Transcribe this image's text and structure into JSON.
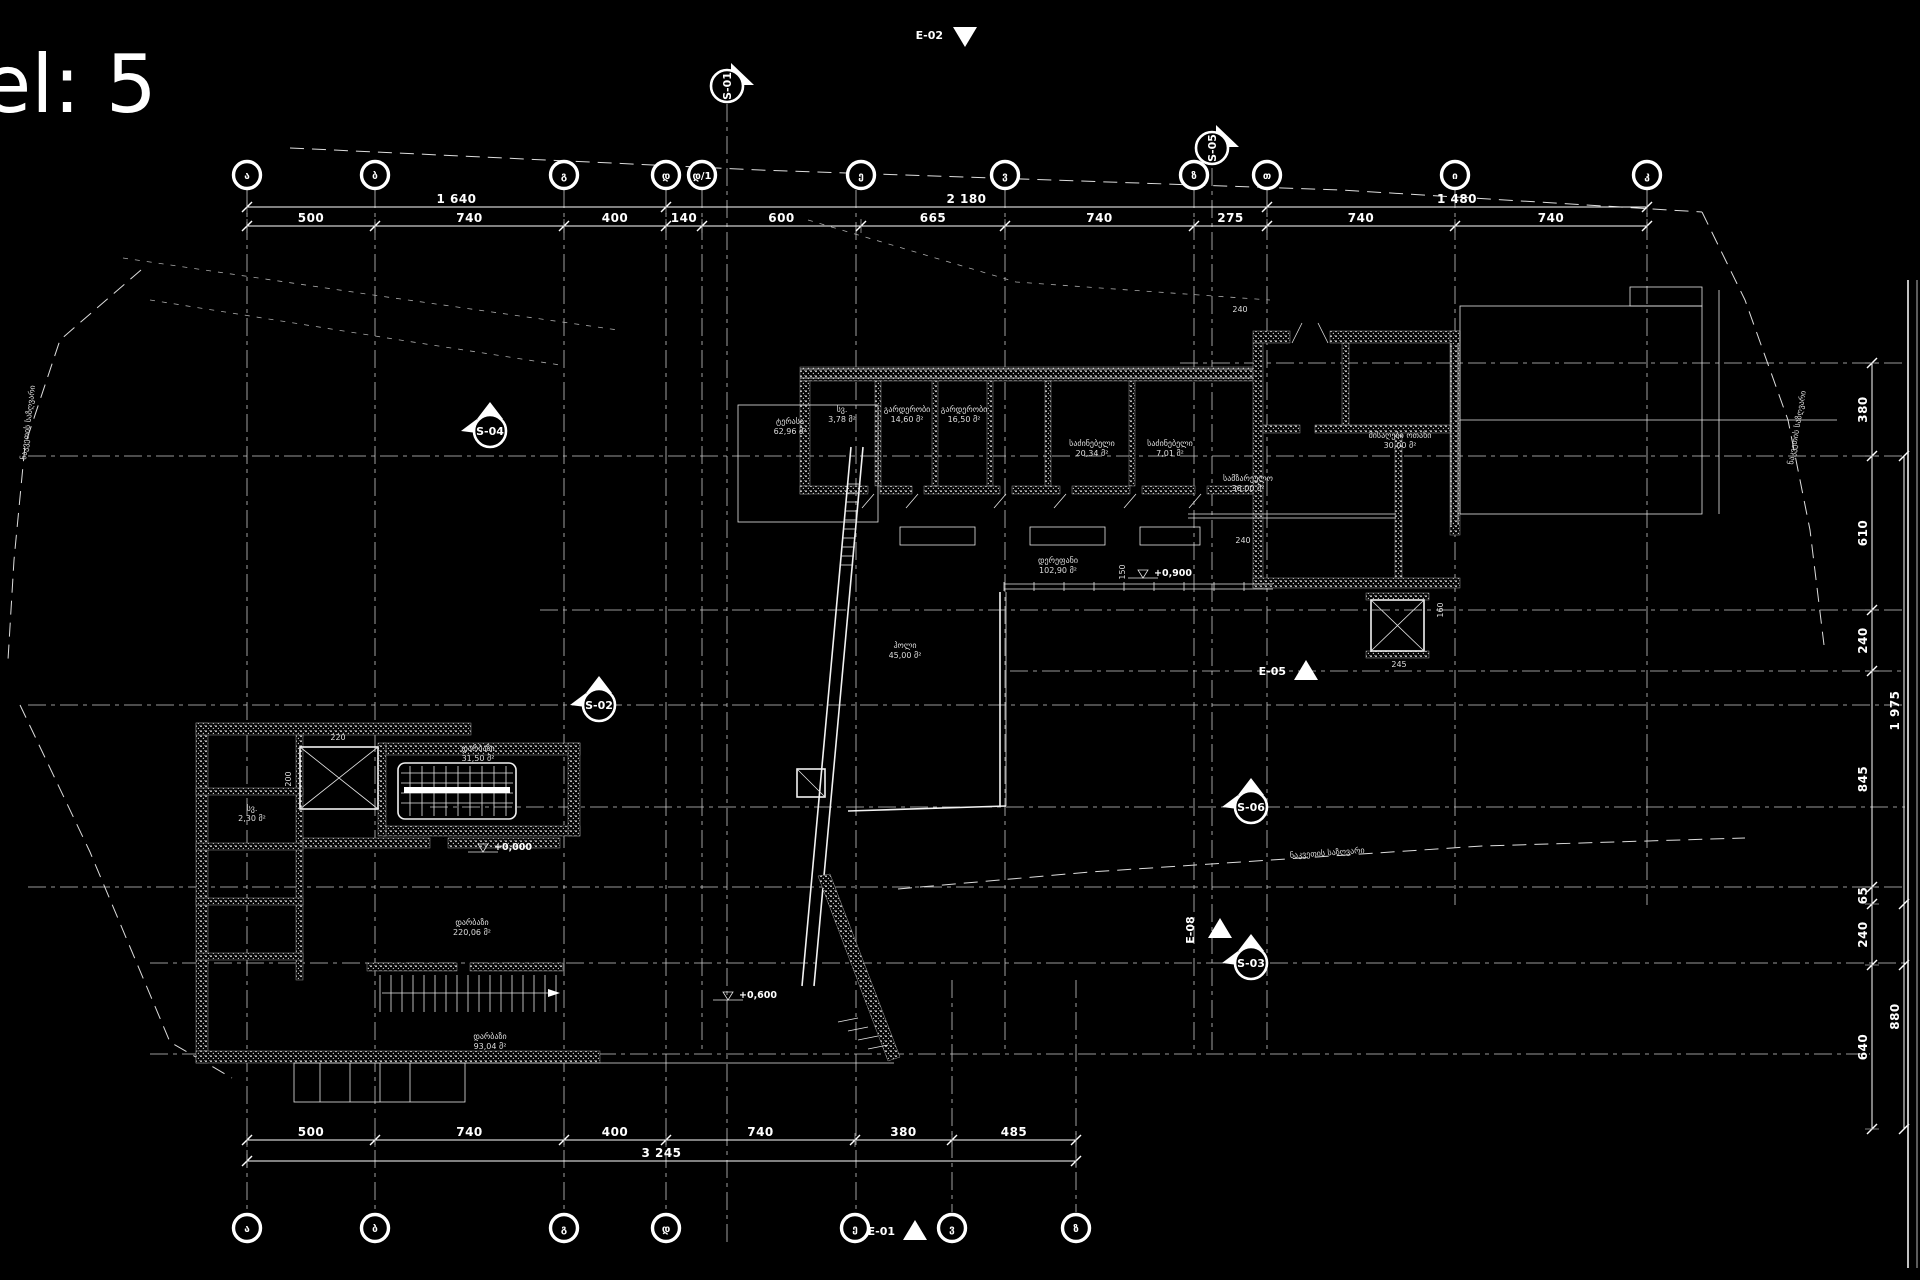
{
  "title": {
    "text": "el: 5"
  },
  "grid": {
    "top": [
      {
        "label": "ა",
        "x": 247
      },
      {
        "label": "ბ",
        "x": 375
      },
      {
        "label": "გ",
        "x": 564
      },
      {
        "label": "დ",
        "x": 666
      },
      {
        "label": "დ/1",
        "x": 702
      },
      {
        "label": "ე",
        "x": 861
      },
      {
        "label": "ვ",
        "x": 1005
      },
      {
        "label": "ზ",
        "x": 1194
      },
      {
        "label": "თ",
        "x": 1267
      },
      {
        "label": "ი",
        "x": 1455
      },
      {
        "label": "კ",
        "x": 1647
      }
    ],
    "bottom": [
      {
        "label": "ა",
        "x": 247
      },
      {
        "label": "ბ",
        "x": 375
      },
      {
        "label": "გ",
        "x": 564
      },
      {
        "label": "დ",
        "x": 666
      },
      {
        "label": "ე",
        "x": 855
      },
      {
        "label": "ვ",
        "x": 952
      },
      {
        "label": "ზ",
        "x": 1076
      }
    ]
  },
  "dimensions": {
    "top_row1": [
      "1 640",
      "2 180",
      "1 480"
    ],
    "top_row2": [
      "500",
      "740",
      "400",
      "140",
      "600",
      "665",
      "740",
      "275",
      "740",
      "740"
    ],
    "bottom_row1": [
      "500",
      "740",
      "400",
      "740",
      "380",
      "485"
    ],
    "bottom_total": [
      "3 245"
    ],
    "right_inner": [
      "380",
      "610",
      "240",
      "845",
      "65",
      "240",
      "640"
    ],
    "right_outer": [
      {
        "label": "1 975",
        "y1": 456,
        "y2": 965
      },
      {
        "label": "880",
        "y1": 904,
        "y2": 1129
      }
    ]
  },
  "section_markers": [
    {
      "id": "E-02",
      "x": 955,
      "y": 35,
      "kind": "tri-down"
    },
    {
      "id": "S-01",
      "x": 727,
      "y": 86,
      "kind": "circle-right"
    },
    {
      "id": "S-05",
      "x": 1212,
      "y": 148,
      "kind": "circle-right"
    },
    {
      "id": "S-04",
      "x": 490,
      "y": 431,
      "kind": "circle-up"
    },
    {
      "id": "S-02",
      "x": 599,
      "y": 705,
      "kind": "circle-up"
    },
    {
      "id": "S-06",
      "x": 1251,
      "y": 807,
      "kind": "circle-up"
    },
    {
      "id": "S-03",
      "x": 1251,
      "y": 963,
      "kind": "circle-up"
    },
    {
      "id": "E-05",
      "x": 1296,
      "y": 671,
      "kind": "tri-up"
    },
    {
      "id": "E-08",
      "x": 1194,
      "y": 930,
      "kind": "tri-vert"
    },
    {
      "id": "E-01",
      "x": 905,
      "y": 1231,
      "kind": "tri-up"
    }
  ],
  "rooms": [
    {
      "name": "სვ.",
      "area": "3,78 მ²",
      "x": 842,
      "y": 412
    },
    {
      "name": "გარდერობი",
      "area": "14,60 მ²",
      "x": 907,
      "y": 412
    },
    {
      "name": "გარდერობი",
      "area": "16,50 მ²",
      "x": 964,
      "y": 412
    },
    {
      "name": "საძინებელი",
      "area": "20,34 მ²",
      "x": 1092,
      "y": 446
    },
    {
      "name": "საძინებელი",
      "area": "7,01 მ²",
      "x": 1170,
      "y": 446
    },
    {
      "name": "სამზარეულო",
      "area": "36,00 მ²",
      "x": 1248,
      "y": 481
    },
    {
      "name": "მისაღები ოთახი",
      "area": "30,00 მ²",
      "x": 1400,
      "y": 438
    },
    {
      "name": "დერეფანი",
      "area": "102,90 მ²",
      "x": 1058,
      "y": 563
    },
    {
      "name": "ტერასა",
      "area": "62,96 მ²",
      "x": 790,
      "y": 424
    },
    {
      "name": "ჰოლი",
      "area": "45,00 მ²",
      "x": 905,
      "y": 648
    },
    {
      "name": "დარბაზი",
      "area": "31,50 მ²",
      "x": 478,
      "y": 751
    },
    {
      "name": "სვ.",
      "area": "2,30 მ²",
      "x": 252,
      "y": 811
    },
    {
      "name": "დარბაზი",
      "area": "220,06 მ²",
      "x": 472,
      "y": 925
    },
    {
      "name": "დარბაზი",
      "area": "93,04 მ²",
      "x": 490,
      "y": 1039
    }
  ],
  "levels": [
    {
      "text": "+0,900",
      "x": 1152,
      "y": 578
    },
    {
      "text": "+0,600",
      "x": 737,
      "y": 1000
    },
    {
      "text": "+0,000",
      "x": 492,
      "y": 852
    }
  ],
  "small_dims": [
    {
      "t": "220",
      "x": 338,
      "y": 740,
      "rot": 0
    },
    {
      "t": "200",
      "x": 291,
      "y": 779,
      "rot": -90
    },
    {
      "t": "240",
      "x": 1243,
      "y": 543,
      "rot": 0
    },
    {
      "t": "245",
      "x": 1399,
      "y": 667,
      "rot": 0
    },
    {
      "t": "150",
      "x": 1125,
      "y": 572,
      "rot": -90
    },
    {
      "t": "160",
      "x": 1443,
      "y": 610,
      "rot": -90
    },
    {
      "t": "240",
      "x": 1240,
      "y": 312,
      "rot": 0
    }
  ],
  "boundary_labels": [
    {
      "text": "ნაკვეთის საზღვარი",
      "x": 26,
      "y": 460,
      "rot": -83
    },
    {
      "text": "ნაკვეთის საზღვარი",
      "x": 1793,
      "y": 465,
      "rot": -80
    },
    {
      "text": "ნაკვეთის საზღვარი",
      "x": 1290,
      "y": 858,
      "rot": -4
    }
  ]
}
